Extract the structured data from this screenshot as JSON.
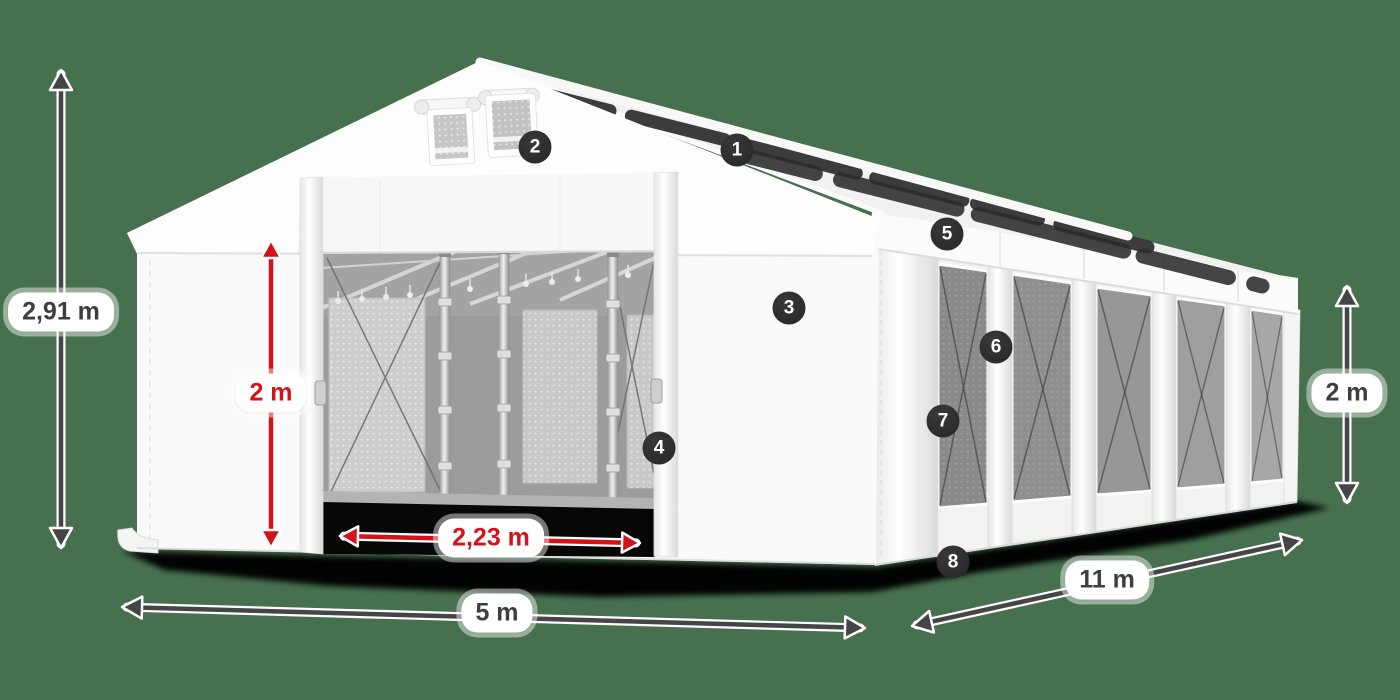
{
  "colors": {
    "background": "#47704e",
    "arrow_dark": "#454545",
    "arrow_red": "#d31318",
    "label_bg": "#ffffff",
    "label_text": "#3e3e3e",
    "badge_bg": "#2b2b2b",
    "badge_text": "#ffffff"
  },
  "dimensions": {
    "total_height": "2,91 m",
    "door_height": "2 m",
    "door_width": "2,23 m",
    "front_width": "5 m",
    "side_length": "11 m",
    "side_wall_height": "2 m"
  },
  "callouts": [
    "1",
    "2",
    "3",
    "4",
    "5",
    "6",
    "7",
    "8"
  ]
}
